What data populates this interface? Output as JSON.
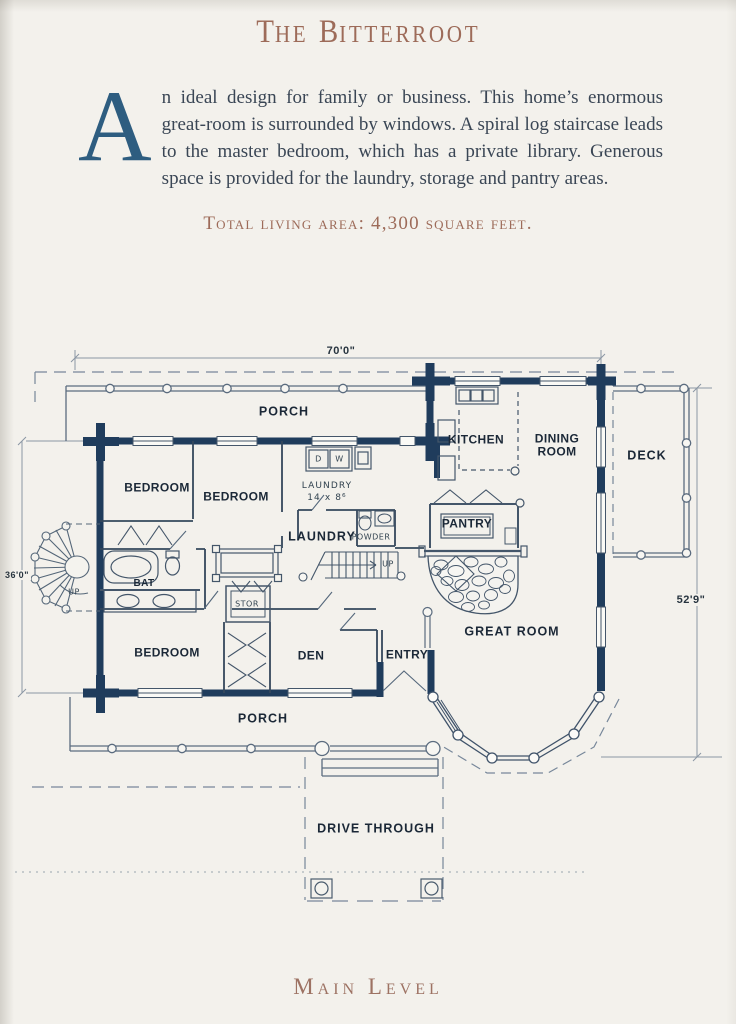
{
  "page_title": {
    "t1": "T",
    "t2": "HE",
    "t3": "B",
    "t4": "ITTERROOT"
  },
  "intro": {
    "drop_cap": "A",
    "text": "n ideal design for family or business. This home’s enormous great-room is surrounded by windows. A spiral log staircase leads to the master bedroom, which has a private library. Generous space is provided for the laundry, storage and pantry areas."
  },
  "total_area": "Total living area: 4,300 square feet.",
  "footer": "Main Level",
  "plan": {
    "dimensions": {
      "top": "70'0\"",
      "left": "36'0\"",
      "right": "52'9\""
    },
    "rooms": {
      "porch_top": "PORCH",
      "kitchen": "KITCHEN",
      "dining_1": "DINING",
      "dining_2": "ROOM",
      "deck": "DECK",
      "bedroom_1": "BEDROOM",
      "bedroom_2": "BEDROOM",
      "bedroom_3": "BEDROOM",
      "laundry": "LAUNDRY",
      "powder": "POWDER",
      "pantry": "PANTRY",
      "bath": "BAT",
      "storage": "STOR",
      "den": "DEN",
      "entry": "ENTRY",
      "great_room": "GREAT ROOM",
      "porch_bottom": "PORCH",
      "drive_through": "DRIVE THROUGH"
    },
    "annotations": {
      "laundry_note_1": "LAUNDRY",
      "laundry_note_2": "14 x 8⁶",
      "dryer": "D",
      "washer": "W",
      "up_main": "UP",
      "up_spiral": "UP"
    }
  },
  "colors": {
    "heading": "#9d6b59",
    "drop_cap": "#2e5d80",
    "wall_navy": "#1f3c5c",
    "label_ink": "#1b2837",
    "page_background": "#f3f1ec"
  }
}
